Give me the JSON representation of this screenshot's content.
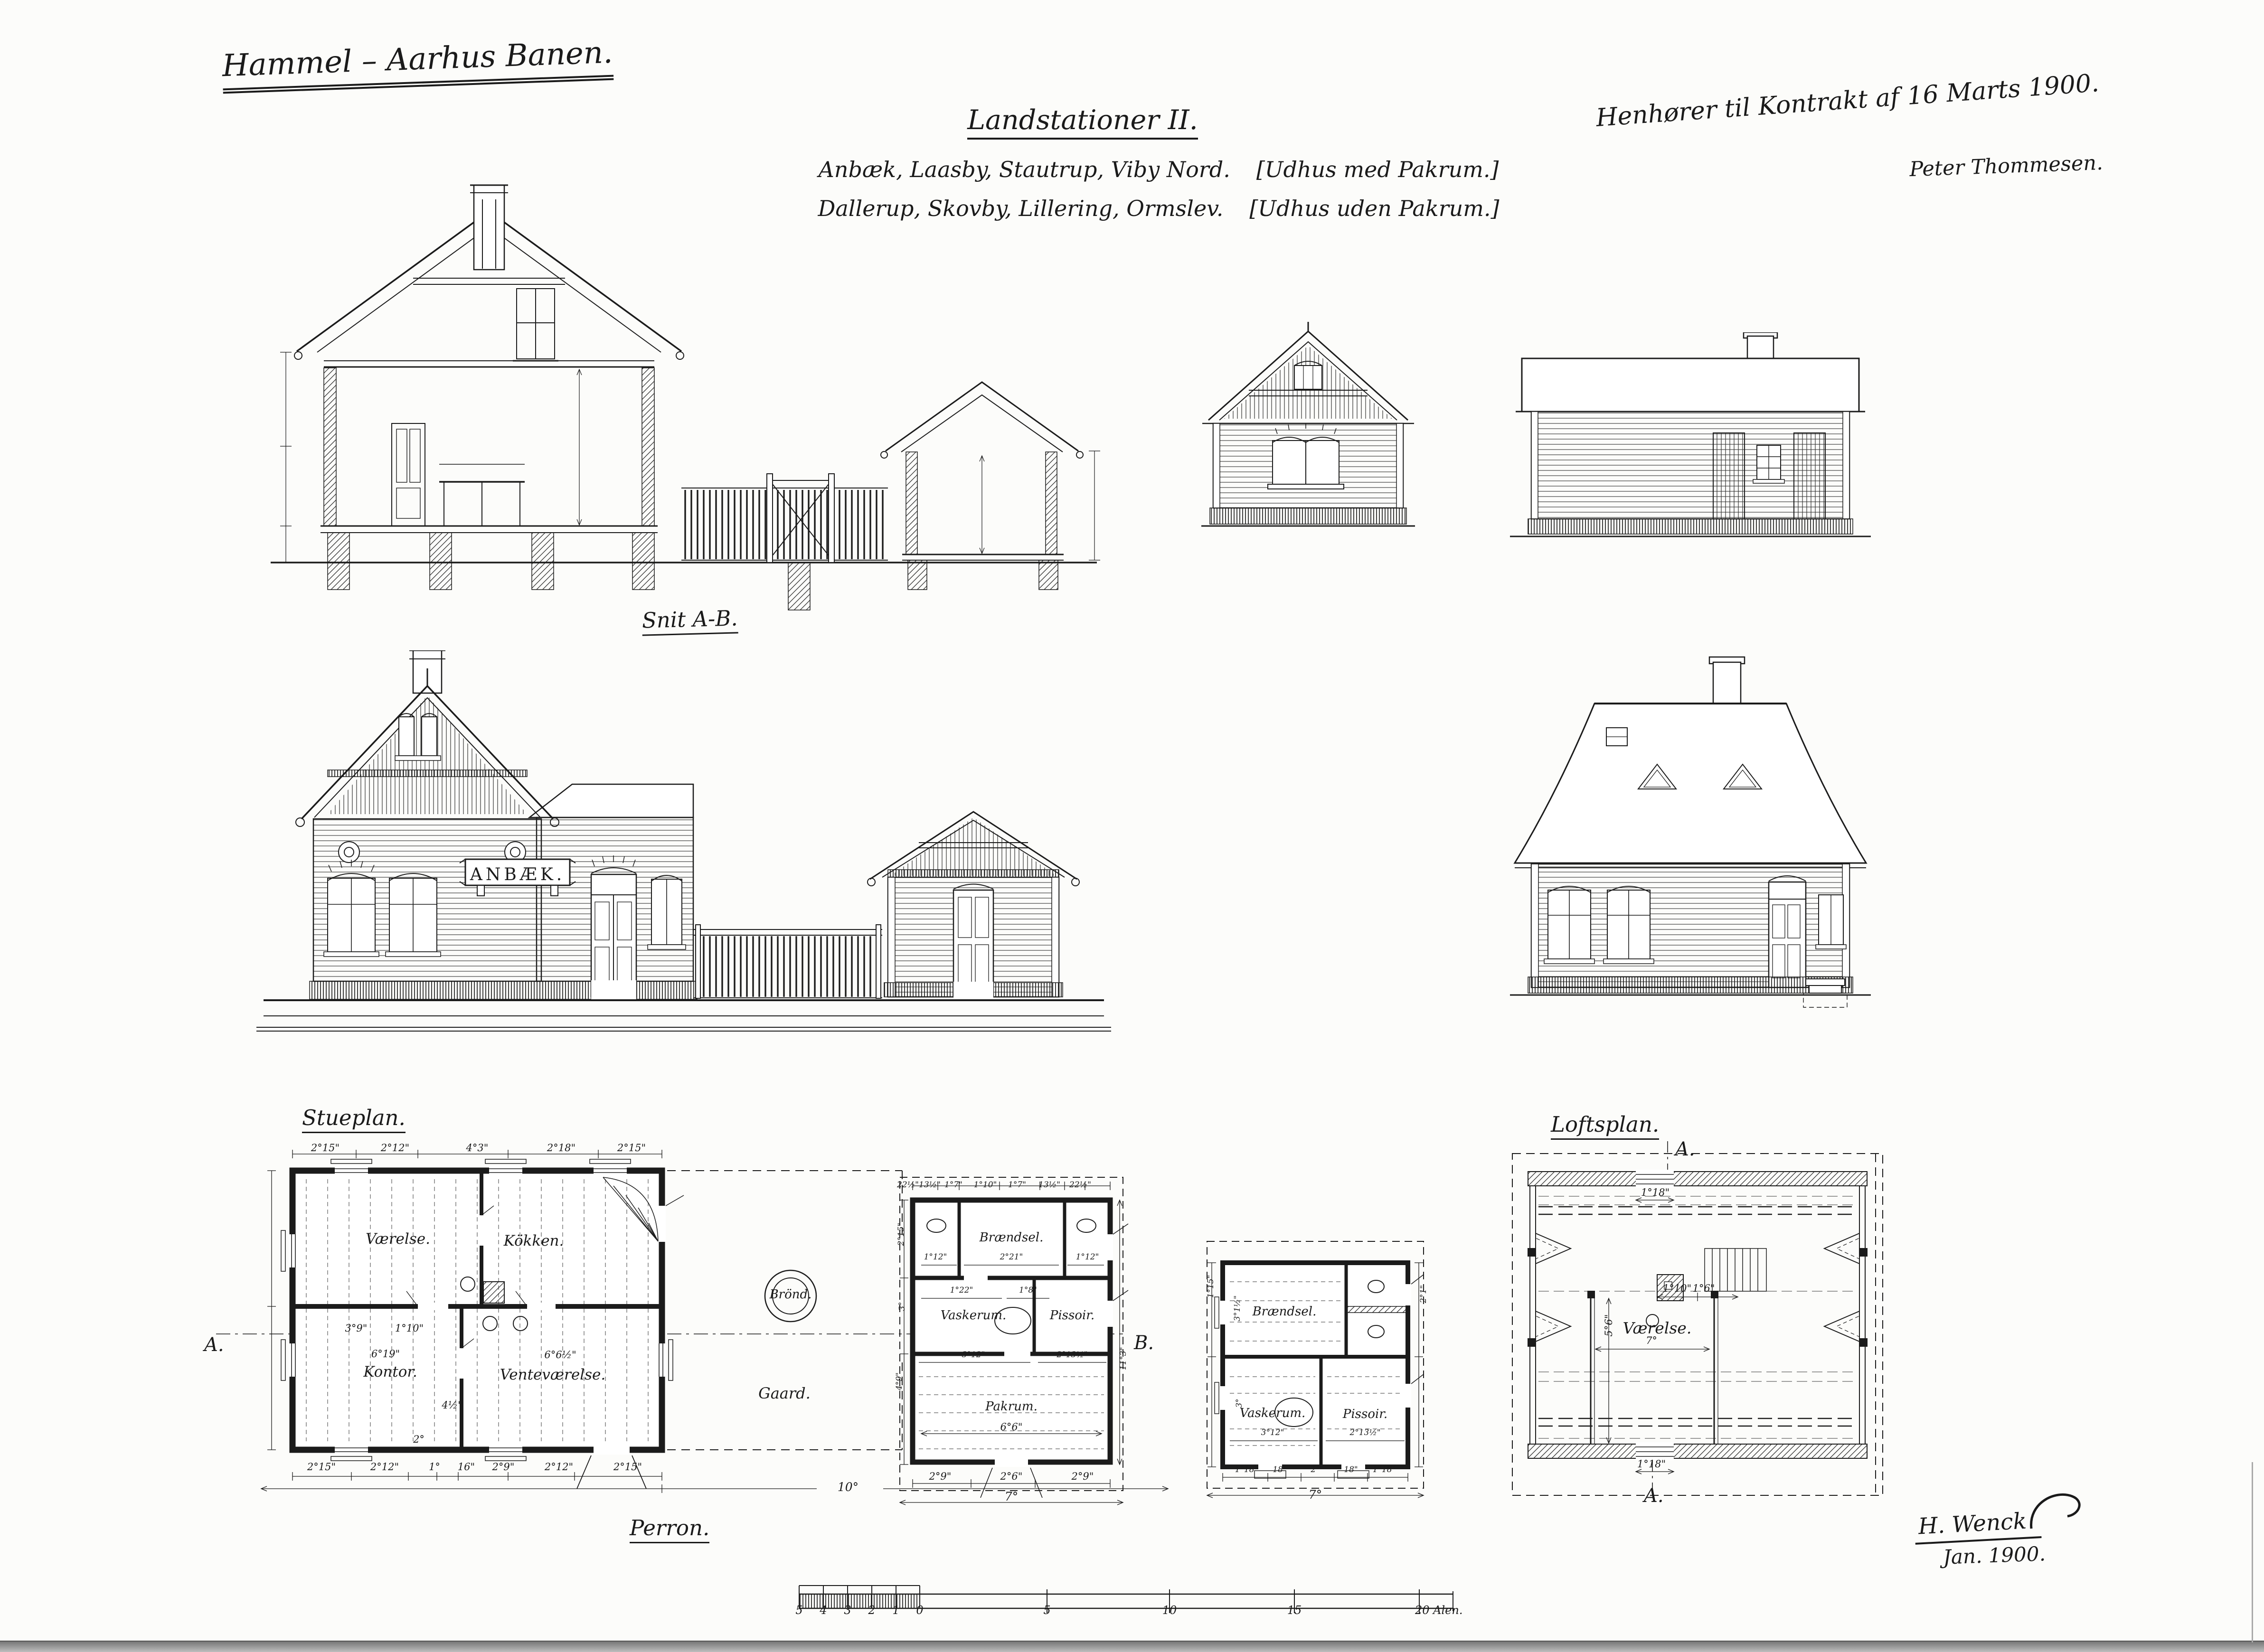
{
  "titles": {
    "railway": "Hammel – Aarhus Banen.",
    "drawing": "Landstationer II.",
    "stations_line1": "Anbæk, Laasby, Stautrup, Viby Nord.",
    "stations_line1_note": "[Udhus med Pakrum.]",
    "stations_line2": "Dallerup, Skovby, Lillering, Ormslev.",
    "stations_line2_note": "[Udhus uden Pakrum.]",
    "contract_note": "Henhører til Kontrakt af 16 Marts 1900.",
    "contract_signer": "Peter Thommesen.",
    "section_label": "Snit A-B.",
    "stueplan_label": "Stueplan.",
    "loftsplan_label": "Loftsplan.",
    "perron_label": "Perron.",
    "station_sign": "ANBÆK.",
    "signature": "H. Wenck",
    "signature_date": "Jan. 1900."
  },
  "stueplan": {
    "rooms": {
      "vaerelse": "Værelse.",
      "kokken": "Kökken.",
      "kontor": "Kontor.",
      "ventevaerelse": "Venteværelse."
    },
    "well_label": "Brönd.",
    "yard_label": "Gaard.",
    "marker_a": "A.",
    "marker_b": "B.",
    "dims_top": [
      "2°15\"",
      "2°12\"",
      "4°3\"",
      "2°18\"",
      "2°15\""
    ],
    "dims_bottom": [
      "2°15\"",
      "2°12\"",
      "1°",
      "16\"",
      "2°9\"",
      "2°12\"",
      "2°15\""
    ],
    "dim_kontor": "6°19\"",
    "dim_vente": "6°6½\"",
    "dim_inner1": "3°9\"",
    "dim_inner2": "1°10\"",
    "dim_inner3": "4½\"",
    "dim_stair": "2°",
    "dim_perron": "10°"
  },
  "udhus1": {
    "rooms": {
      "braendsel": "Brændsel.",
      "vaskerum": "Vaskerum.",
      "pissoir": "Pissoir.",
      "pakrum": "Pakrum."
    },
    "dims_top": [
      "22½\"",
      "13½\"",
      "1°7\"",
      "1°10\"",
      "1°7\"",
      "13½\"",
      "22½\""
    ],
    "dims_mid": [
      "1°12\"",
      "2°21\"",
      "1°12\""
    ],
    "dims_row2": [
      "1°22\"",
      "1°8\""
    ],
    "dims_row3": [
      "3°12\"",
      "2°13½\""
    ],
    "dim_pakrum_w": "6°6\"",
    "dims_bottom": [
      "2°9\"",
      "2°6\"",
      "2°9\""
    ],
    "dim_total_w": "7°",
    "dim_total_h": "11°3\"",
    "rot1": "2°15\"",
    "rot2": "3°",
    "rot3": "4°9\""
  },
  "udhus2": {
    "rooms": {
      "braendsel": "Brændsel.",
      "vaskerum": "Vaskerum.",
      "pissoir": "Pissoir."
    },
    "dims_row3": [
      "3°12\"",
      "2°13½\""
    ],
    "dims_bottom": [
      "1°18\"",
      "18\"",
      "2°",
      "18\"",
      "1°18\""
    ],
    "dim_total_w": "7°",
    "rot_left1": "3°1½\"",
    "rot_left2": "3°",
    "rot_right": "2°1\"",
    "rot_out": "1°15\""
  },
  "loftsplan": {
    "room": "Værelse.",
    "marker_top": "A.",
    "marker_bottom": "A.",
    "dim_top": "1°18\"",
    "dim_bottom": "1°18\"",
    "dim_width": "7°",
    "dim_height": "5°6\"",
    "dim_stair1": "1°10\"",
    "dim_stair2": "1°6\""
  },
  "scalebar": {
    "minor": [
      "5",
      "4",
      "3",
      "2",
      "1",
      "0"
    ],
    "major": [
      "5",
      "10",
      "15"
    ],
    "end": "20 Alen."
  }
}
